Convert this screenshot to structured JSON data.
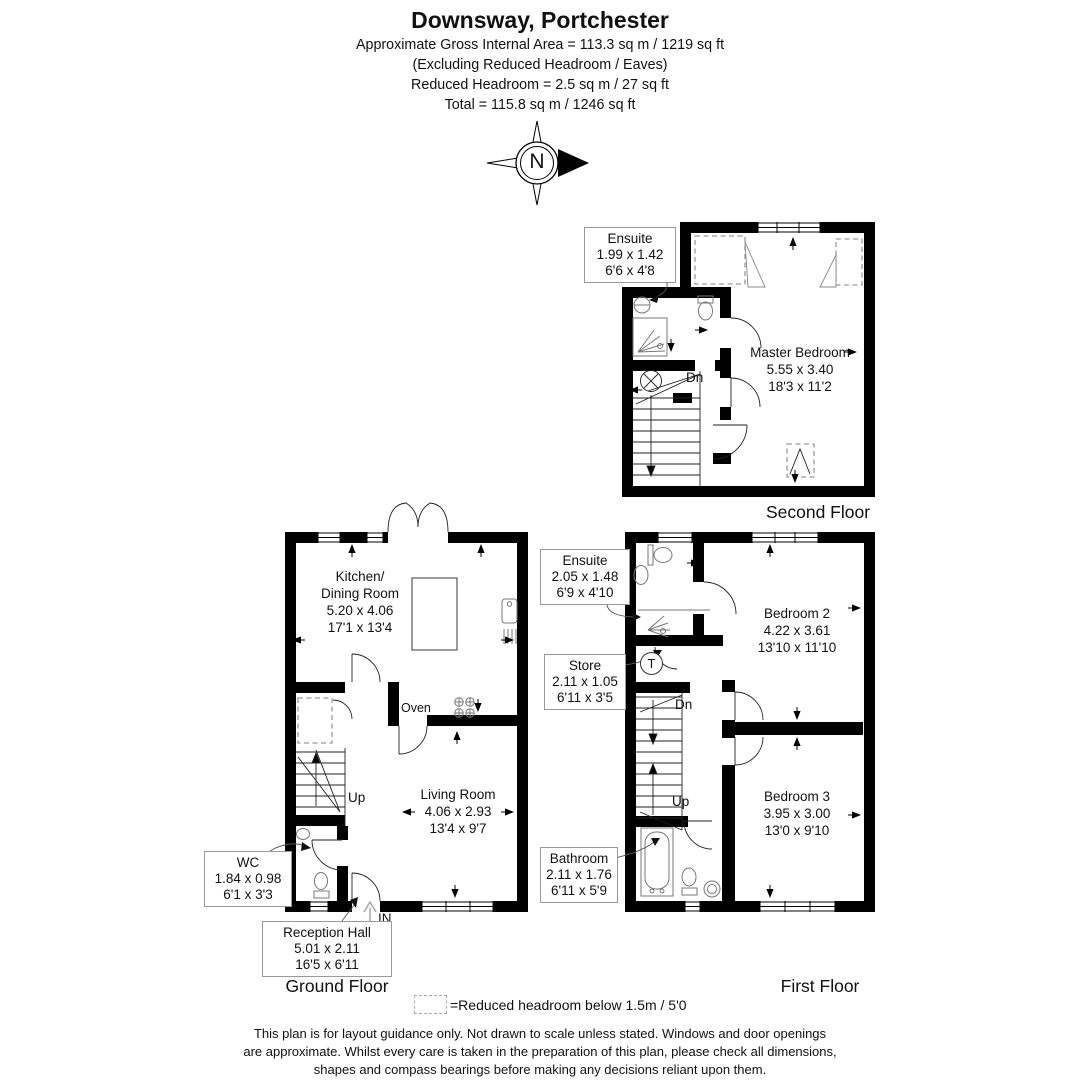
{
  "header": {
    "title": "Downsway, Portchester",
    "area_line1": "Approximate Gross Internal Area = 113.3 sq m / 1219 sq ft",
    "area_line2": "(Excluding Reduced Headroom / Eaves)",
    "area_line3": "Reduced Headroom = 2.5 sq m / 27 sq ft",
    "area_line4": "Total = 115.8 sq m / 1246 sq ft"
  },
  "compass": {
    "north_label": "N"
  },
  "floors": {
    "second": {
      "name": "Second Floor",
      "stairs_down_label": "Dn",
      "rooms": {
        "master_bedroom": {
          "name": "Master Bedroom",
          "metric": "5.55 x 3.40",
          "imperial": "18'3 x 11'2"
        },
        "ensuite": {
          "name": "Ensuite",
          "metric": "1.99 x 1.42",
          "imperial": "6'6 x 4'8"
        }
      }
    },
    "ground": {
      "name": "Ground Floor",
      "stairs_up_label": "Up",
      "entrance_label": "IN",
      "oven_label": "Oven",
      "rooms": {
        "kitchen_dining": {
          "name_line1": "Kitchen/",
          "name_line2": "Dining Room",
          "metric": "5.20 x 4.06",
          "imperial": "17'1 x 13'4"
        },
        "living_room": {
          "name": "Living Room",
          "metric": "4.06 x 2.93",
          "imperial": "13'4 x 9'7"
        },
        "wc": {
          "name": "WC",
          "metric": "1.84 x 0.98",
          "imperial": "6'1 x 3'3"
        },
        "reception_hall": {
          "name": "Reception Hall",
          "metric": "5.01 x 2.11",
          "imperial": "16'5 x 6'11"
        }
      }
    },
    "first": {
      "name": "First Floor",
      "stairs_down_label": "Dn",
      "stairs_up_label": "Up",
      "tank_label": "T",
      "rooms": {
        "bedroom_2": {
          "name": "Bedroom 2",
          "metric": "4.22 x 3.61",
          "imperial": "13'10 x 11'10"
        },
        "bedroom_3": {
          "name": "Bedroom 3",
          "metric": "3.95 x 3.00",
          "imperial": "13'0 x 9'10"
        },
        "ensuite": {
          "name": "Ensuite",
          "metric": "2.05 x 1.48",
          "imperial": "6'9 x 4'10"
        },
        "store": {
          "name": "Store",
          "metric": "2.11 x 1.05",
          "imperial": "6'11 x 3'5"
        },
        "bathroom": {
          "name": "Bathroom",
          "metric": "2.11 x 1.76",
          "imperial": "6'11 x 5'9"
        }
      }
    }
  },
  "legend": {
    "reduced_headroom": "=Reduced headroom below 1.5m / 5'0"
  },
  "disclaimer": {
    "line1": "This plan is for layout guidance only. Not drawn to scale unless stated. Windows and door openings",
    "line2": "are approximate. Whilst every care is taken in the preparation of this plan, please check all dimensions,",
    "line3": "shapes and compass bearings before making any decisions reliant upon them."
  },
  "colors": {
    "wall": "#000000",
    "callout_border": "#999999",
    "reduced_headroom_dash": "#9a9a9a",
    "fixture": "#777777"
  }
}
